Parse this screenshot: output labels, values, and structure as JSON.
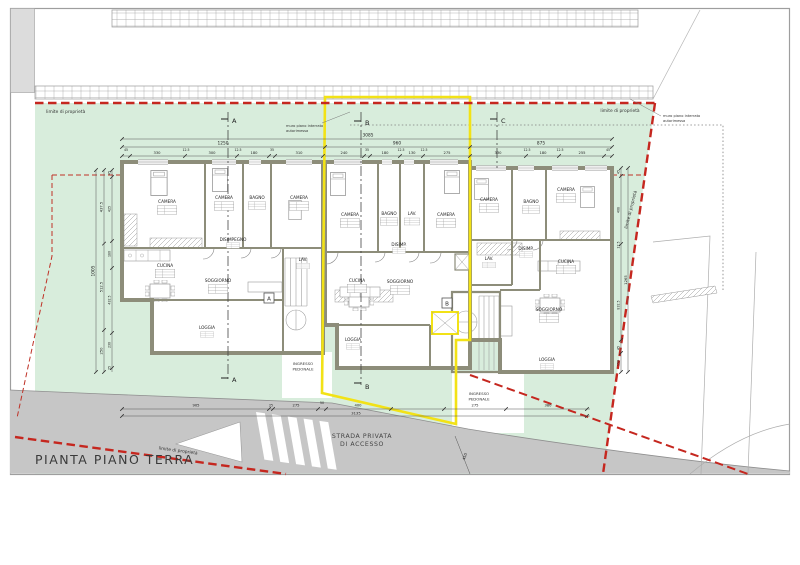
{
  "title": "PIANTA PIANO TERRA",
  "colors": {
    "lawn": "#d8eddc",
    "road": "#c6c6c6",
    "wall": "#8d8d7a",
    "highlight_yellow": "#f2e216",
    "boundary_red": "#c5271f"
  },
  "labels": {
    "property_line_top_left": "limite di proprietà",
    "property_line_top_right": "limite di proprietà",
    "property_line_right": "limite di proprietà",
    "property_line_bottom": "limite di proprietà",
    "garage_wall_line1": "muro piano interrato",
    "garage_wall_line2": "autorimessa",
    "road_line1": "STRADA PRIVATA",
    "road_line2": "DI ACCESSO",
    "entrance_line1": "INGRESSO",
    "entrance_line2": "PEDONALE"
  },
  "sections": {
    "a": "A",
    "b": "B",
    "c": "C"
  },
  "unit_markers": {
    "a": "A",
    "b": "B"
  },
  "units": {
    "left": {
      "rooms": [
        "CAMERA",
        "CAMERA",
        "BAGNO",
        "CAMERA",
        "DISIMPEGNO",
        "LAV.",
        "CUCINA",
        "SOGGIORNO",
        "LOGGIA"
      ]
    },
    "middle": {
      "rooms": [
        "CAMERA",
        "BAGNO",
        "LAV.",
        "CAMERA",
        "DISIMP.",
        "CUCINA",
        "SOGGIORNO",
        "LOGGIA"
      ]
    },
    "right": {
      "rooms": [
        "CAMERA",
        "BAGNO",
        "CAMERA",
        "LAV.",
        "DISIMP.",
        "CUCINA",
        "SOGGIORNO",
        "LOGGIA"
      ]
    }
  },
  "dimensions": {
    "top_overall": "3085",
    "top_totals": [
      "1250",
      "960",
      "875"
    ],
    "top_left": [
      "45",
      "330",
      "12.5",
      "300",
      "12.5",
      "180",
      "35",
      "310"
    ],
    "top_middle": [
      "240",
      "35",
      "180",
      "12.5",
      "130",
      "12.5",
      "275"
    ],
    "top_right": [
      "330",
      "12.5",
      "180",
      "12.5",
      "255",
      "45"
    ],
    "left_outer": "1005",
    "left_mid": [
      "437.5",
      "512.5",
      "250"
    ],
    "left_inner": [
      "45",
      "425",
      "180",
      "432.5",
      "230",
      "25"
    ],
    "right_outer": "1265",
    "right_inner": [
      "45",
      "408",
      "12.5",
      "832.5",
      "45",
      "150"
    ],
    "bottom": [
      "905",
      "25",
      "275",
      "50",
      "400",
      "275",
      "380"
    ],
    "bottom_total": "3135",
    "ramp": "450"
  }
}
